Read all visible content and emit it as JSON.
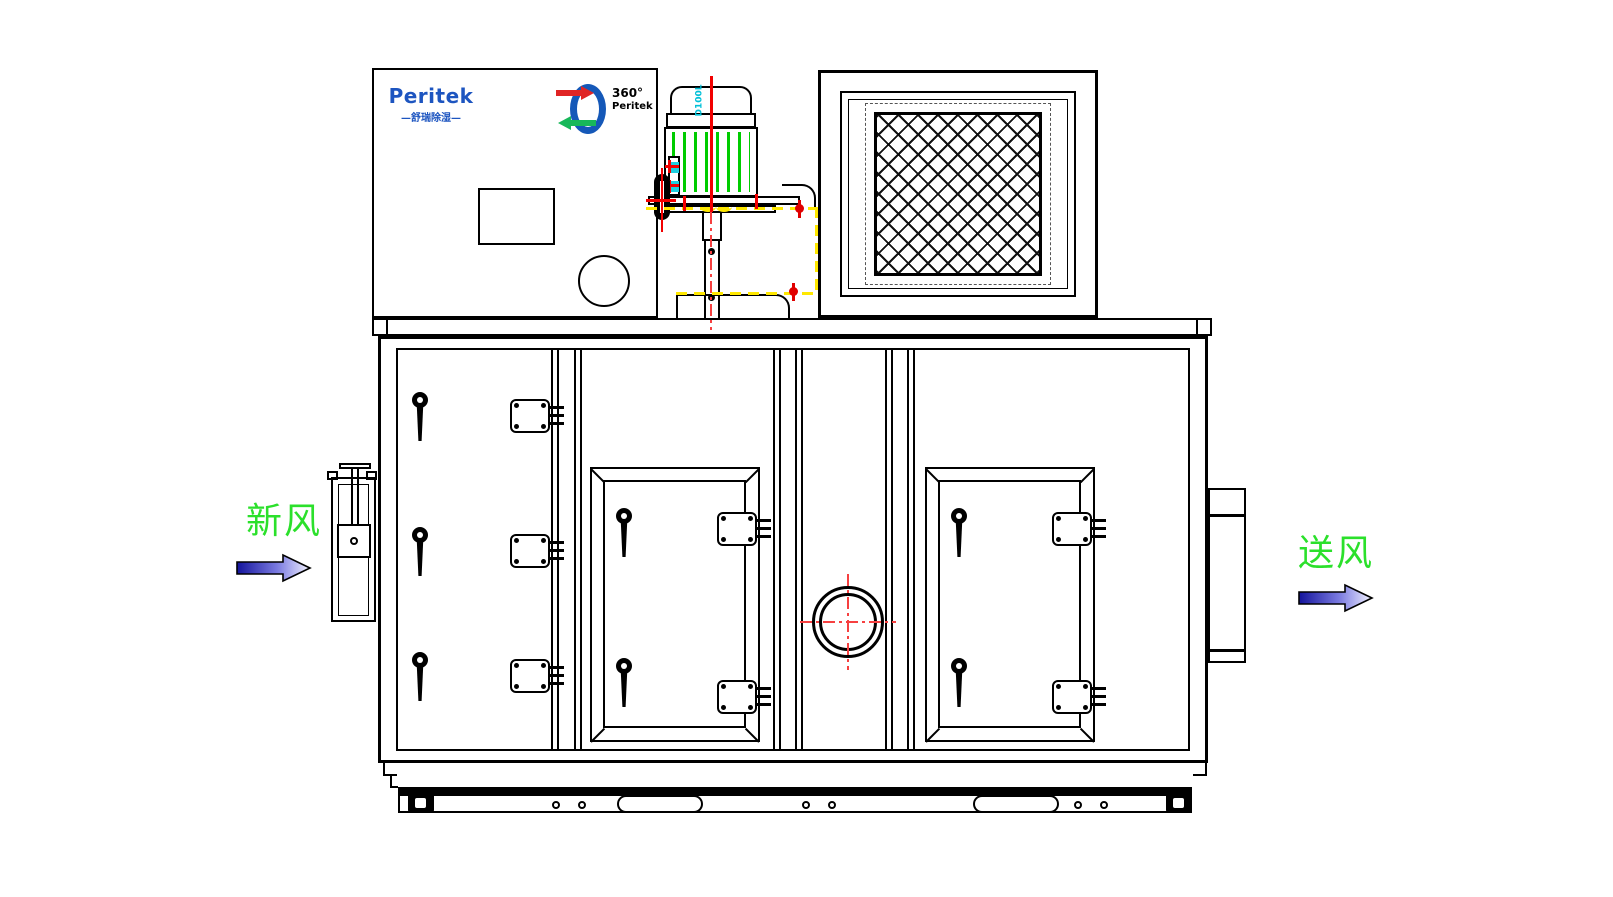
{
  "drawing": {
    "title_block": {
      "brand": {
        "name": "Peritek",
        "tagline": "—舒瑞除湿—"
      },
      "rotor_logo": {
        "degrees": "360°",
        "brand": "Peritek"
      }
    },
    "motor": {
      "model": "D100L"
    },
    "flow_labels": {
      "fresh_air": "新风",
      "supply_air": "送风"
    },
    "colors": {
      "line_black": "#000000",
      "centerline_red": "#f20000",
      "highlight_yellow": "#ffe800",
      "motor_stripe_green": "#00cc00",
      "marker_cyan": "#1ecfe0",
      "brand_blue": "#1d55c0",
      "label_green": "#2be02b",
      "arrow_navy": "#14149c"
    }
  }
}
